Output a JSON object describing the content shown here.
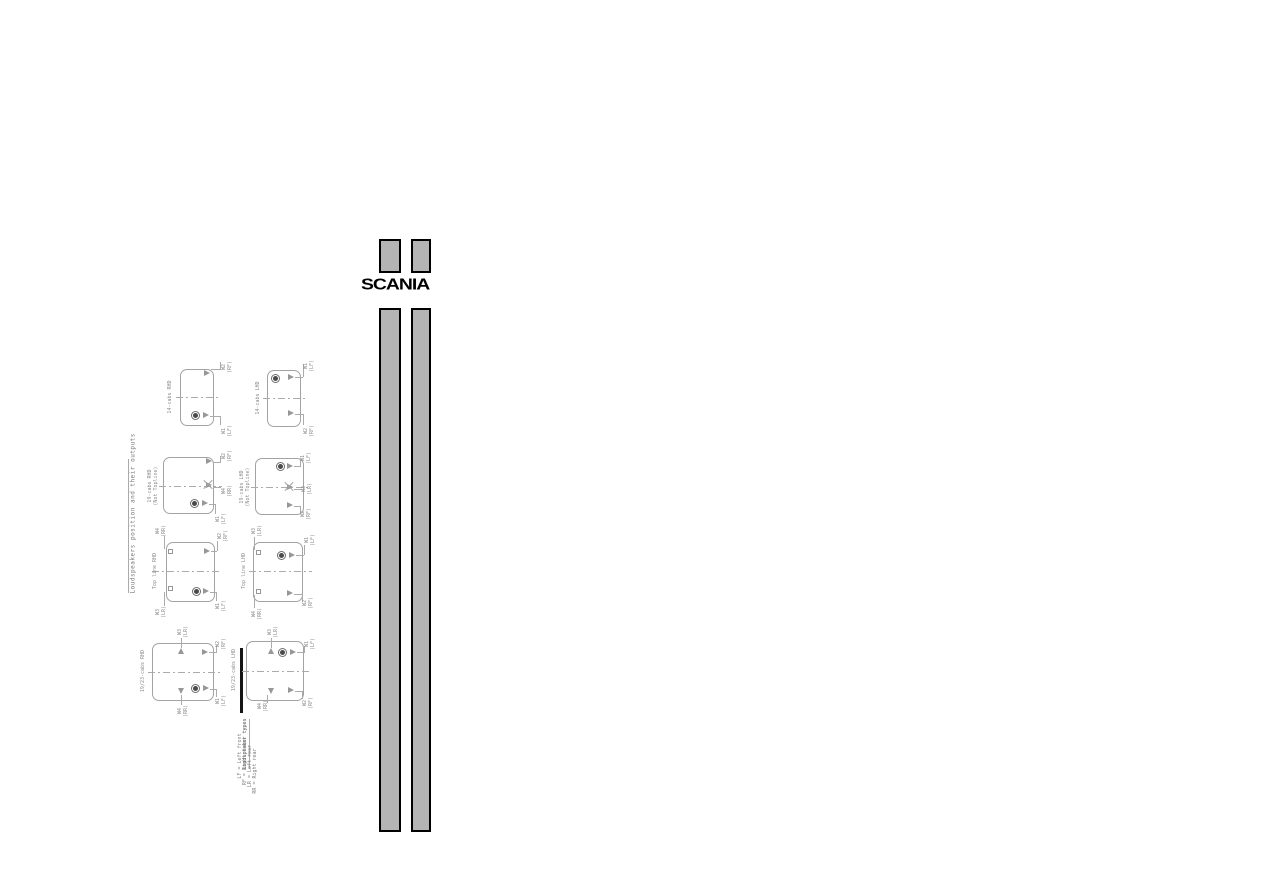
{
  "logo": {
    "text": "SCANIA"
  },
  "title": "Loudspeakers position and their outputs",
  "legend": {
    "title": "Loudspeaker types",
    "items": [
      "LF = Left front",
      "RF = Right front",
      "LR = Left rear",
      "RR = Right rear"
    ]
  },
  "colors": {
    "fold_mark_fill": "#b4b4b4",
    "fold_mark_border": "#000000",
    "diagram_line": "#a3a3a3",
    "diagram_text": "#8a8a8a",
    "logo_color": "#000000"
  },
  "diagrams": [
    {
      "label": "14-cabs RHD",
      "label2": "",
      "speakers": [
        {
          "code": "W2",
          "pos": "(RF)"
        },
        {
          "code": "W1",
          "pos": "(LF)"
        }
      ]
    },
    {
      "label": "14-cabs LHD",
      "label2": "",
      "speakers": [
        {
          "code": "W1",
          "pos": "(LF)"
        },
        {
          "code": "W2",
          "pos": "(RF)"
        }
      ]
    },
    {
      "label": "19-cabs RHD",
      "label2": "(Not Topline)",
      "speakers": [
        {
          "code": "W2",
          "pos": "(RF)"
        },
        {
          "code": "W4",
          "pos": "(RR)"
        },
        {
          "code": "W1",
          "pos": "(LF)"
        }
      ]
    },
    {
      "label": "19-cabs LHD",
      "label2": "(Not Topline)",
      "speakers": [
        {
          "code": "W1",
          "pos": "(LF)"
        },
        {
          "code": "W3",
          "pos": "(LR)"
        },
        {
          "code": "W2",
          "pos": "(RF)"
        }
      ]
    },
    {
      "label": "Top line RHD",
      "label2": "",
      "speakers": [
        {
          "code": "W4",
          "pos": "(RR)"
        },
        {
          "code": "W3",
          "pos": "(LR)"
        },
        {
          "code": "W2",
          "pos": "(RF)"
        },
        {
          "code": "W1",
          "pos": "(LF)"
        }
      ]
    },
    {
      "label": "Top line LHD",
      "label2": "",
      "speakers": [
        {
          "code": "W3",
          "pos": "(LR)"
        },
        {
          "code": "W4",
          "pos": "(RR)"
        },
        {
          "code": "W1",
          "pos": "(LF)"
        },
        {
          "code": "W2",
          "pos": "(RF)"
        }
      ]
    },
    {
      "label": "19/23-cabs RHD",
      "label2": "",
      "speakers": [
        {
          "code": "W3",
          "pos": "(LR)"
        },
        {
          "code": "W2",
          "pos": "(RF)"
        },
        {
          "code": "W4",
          "pos": "(RR)"
        },
        {
          "code": "W1",
          "pos": "(LF)"
        }
      ]
    },
    {
      "label": "19/23-cabs LHD",
      "label2": "",
      "speakers": [
        {
          "code": "W3",
          "pos": "(LR)"
        },
        {
          "code": "W1",
          "pos": "(LF)"
        },
        {
          "code": "W4",
          "pos": "(RR)"
        },
        {
          "code": "W2",
          "pos": "(RF)"
        }
      ]
    }
  ]
}
